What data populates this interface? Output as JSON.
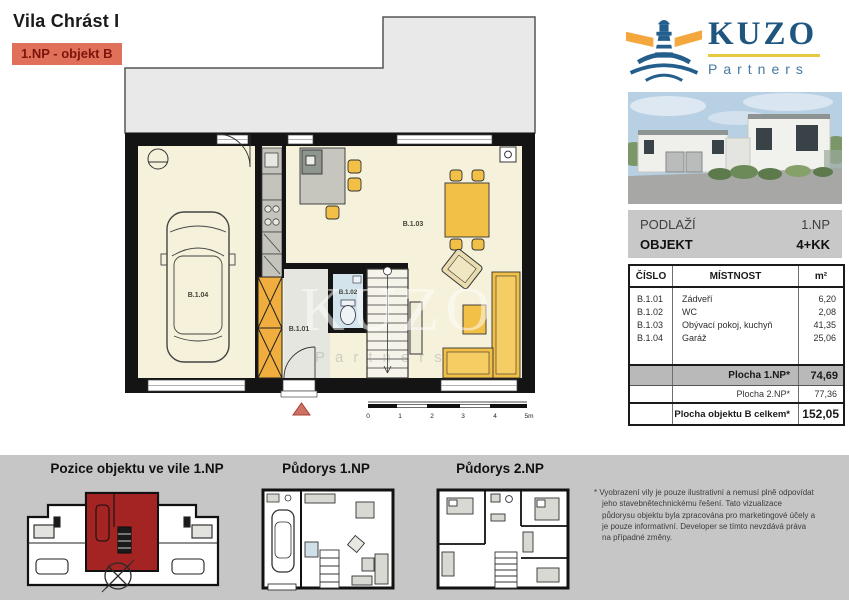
{
  "header": {
    "title": "Vila Chrást I",
    "badge": "1.NP - objekt B",
    "badge_bg": "#e0705a",
    "badge_text_color": "#7c150b"
  },
  "brand": {
    "name": "KUZO",
    "subtitle": "Partners",
    "blue": "#235e8c",
    "beam_orange": "#f3a73c",
    "underline_yellow": "#e7c93f"
  },
  "info": {
    "floor_label": "PODLAŽÍ",
    "floor_value": "1.NP",
    "object_label": "OBJEKT",
    "object_value": "4+KK"
  },
  "table": {
    "headers": [
      "ČÍSLO",
      "MÍSTNOST",
      "m²"
    ],
    "rows": [
      {
        "id": "B.1.01",
        "name": "Zádveří",
        "area": "6,20"
      },
      {
        "id": "B.1.02",
        "name": "WC",
        "area": "2,08"
      },
      {
        "id": "B.1.03",
        "name": "Obývací pokoj, kuchyň",
        "area": "41,35"
      },
      {
        "id": "B.1.04",
        "name": "Garáž",
        "area": "25,06"
      }
    ],
    "summary": [
      {
        "label": "Plocha 1.NP*",
        "value": "74,69"
      },
      {
        "label": "Plocha 2.NP*",
        "value": "77,36"
      },
      {
        "label": "Plocha objektu B celkem*",
        "value": "152,05"
      }
    ]
  },
  "plan": {
    "labels": [
      "B.1.01",
      "B.1.02",
      "B.1.03",
      "B.1.04"
    ],
    "scale": [
      "0",
      "1",
      "2",
      "3",
      "4",
      "5m"
    ],
    "watermark_line1": "KUZO",
    "watermark_line2": "Partners",
    "floor_color": "#f5f1da",
    "furniture_yellow": "#f2bf47",
    "wardrobe_orange": "#efae3d",
    "wc_floor": "#d3e4ec",
    "entrance_marker": "#cd7165"
  },
  "thumbnails": {
    "position_title": "Pozice objektu ve vile 1.NP",
    "plan1_title": "Půdorys 1.NP",
    "plan2_title": "Půdorys 2.NP",
    "highlight_red": "#a32422"
  },
  "disclaimer": "* Vyobrazení vily je pouze ilustrativní a nemusí plně odpovídat jeho stavebnětechnickému řešení. Tato vizualizace půdorysu objektu byla zpracována pro marketingové účely a je pouze informativní. Developer se tímto nevzdává práva na případné změny."
}
